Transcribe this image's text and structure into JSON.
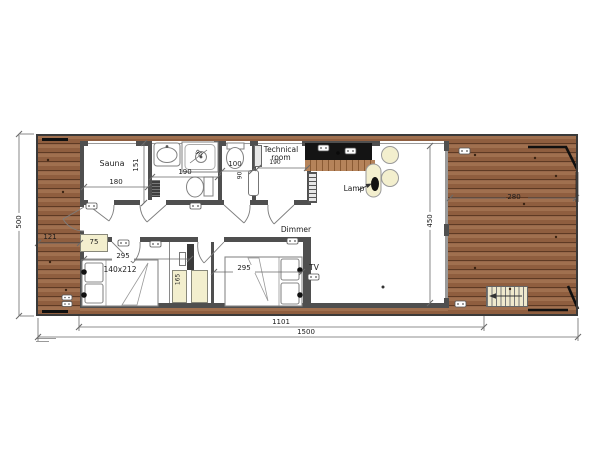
{
  "labels": {
    "sauna": "Sauna",
    "technical_room": "Technical room",
    "lamp": "Lamp",
    "dimmer": "Dimmer",
    "tv": "TV"
  },
  "dimensions": {
    "overall_length": "1500",
    "interior_length": "1101",
    "overall_depth": "500",
    "living_depth": "450",
    "deck_left": "121",
    "deck_right": "280",
    "sauna_width": "180",
    "sauna_depth": "151",
    "bath_width": "190",
    "shower": "90",
    "wc_width": "100",
    "tech_dim": "190",
    "cabinet_dim": "90",
    "bed1_width": "295",
    "bed2_width": "295",
    "bed_size": "140x212",
    "wardrobe": "75",
    "closet_depth": "165"
  },
  "colors": {
    "deck_wood": "#96654a",
    "kitchen_wood": "#b5835a",
    "counter": "#141414",
    "wall": "#4f4f4f",
    "furniture_cream": "#f3efce",
    "railing": "#101010"
  }
}
